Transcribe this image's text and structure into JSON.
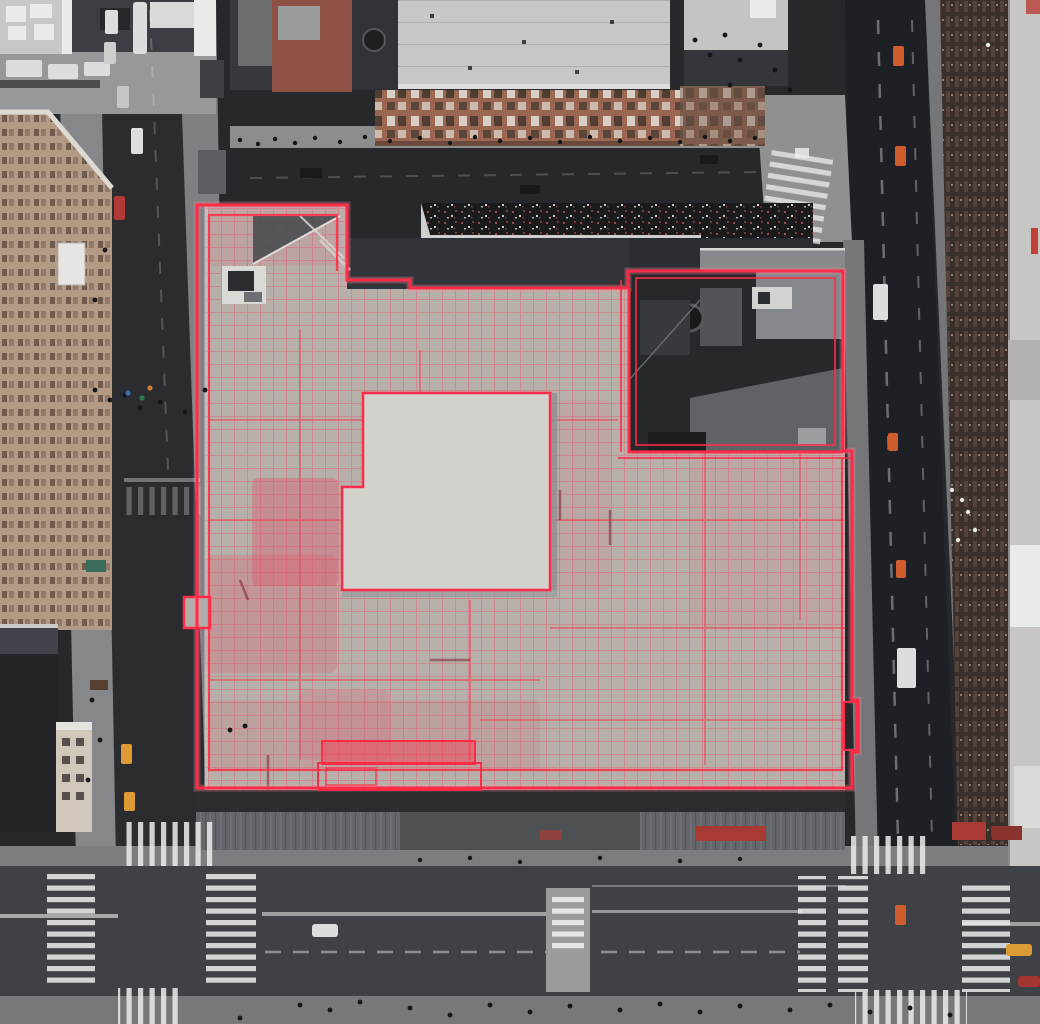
{
  "scene": {
    "type": "aerial-satellite-photograph",
    "subject": "downtown city block viewed from directly overhead",
    "annotation": "red building-footprint outline overlay with CAD-style grid markings on the central rooftop",
    "visible_text": "none",
    "features": {
      "central_block": "large light-gray warehouse rooftop outlined in red",
      "inset_building": "dark rooftop parcel in the north-east corner of the block, separately outlined",
      "raised_roof": "white raised L-shaped roof section at center",
      "green_roof_strip": "dark planted roof strip along the north edge",
      "streets": [
        "left vertical street",
        "top cross street",
        "right avenue",
        "bottom boulevard with median"
      ],
      "crosswalks": "white ladder crosswalks at both intersections",
      "vehicles": [
        "yellow taxis",
        "orange taxis",
        "white box trucks",
        "white cars",
        "red car"
      ],
      "surrounding_buildings": [
        "tan brick mid-rise (west)",
        "red-brick facade block (north)",
        "dark brown high-rise (east)"
      ]
    }
  },
  "colors": {
    "bg_street": "#26282c",
    "avenue": "#1d2024",
    "street_left": "#2a2c30",
    "street_bottom": "#3e4145",
    "sidewalk": "#85878a",
    "sidewalk_dark": "#7e8083",
    "sidewalk_east": "#74767a",
    "sidewalk_bottom": "#76787b",
    "sidewalk_north": "#7b7d80",
    "plaza": "#96989a",
    "plaza_right": "#8e9092",
    "sidewalk_top": "#8b8d90",
    "roof_main": "#b6b4ae",
    "roof_raised": "#d2d1cb",
    "roof_big": "#c5c8c6",
    "roof_light": "#c3c5c3",
    "roof_far_right": "#c8c6c2",
    "strip_green_roof": "#191b1c",
    "shadow_roof": "#303338",
    "shadow_roof2": "#2a2d31",
    "sliver_gray": "#87898c",
    "inset_base": "#26282b",
    "inset_light": "#84878b",
    "inset_mid": "#5f6266",
    "inset_panel": "#515458",
    "dark_roof": "#35383c",
    "dark_roof_light": "#6b6e71",
    "dark_bldg": "#232528",
    "alley": "#27292d",
    "brick_facade": "#9b6753",
    "brick_dark": "#7c5a4c",
    "brick_tower": "#8d5243",
    "tan_building": "#b29a84",
    "tan_small": "#cfc8bb",
    "brown_building": "#3a2f2a",
    "white_struct": "#e9ebe9",
    "white_soft": "#d8dad8",
    "crosswalk_white": "#eceded",
    "median": "#9a9c99",
    "south_face": "#63666a",
    "south_dark": "#2b2d31",
    "banner_red": "#a93a33",
    "annotation": "#ff2b47",
    "annotation_glow": "#ff8a97",
    "annotation_soft": "#ef4358",
    "patch_red": "#e05568",
    "maroon": "#7e2430",
    "taxi_yellow": "#dd9b35",
    "taxi_orange": "#cf5c2d",
    "vehicle_white": "#dcdedd",
    "car_red": "#a33530",
    "pedestrian": "#141619",
    "lane_white": "#ffffff"
  }
}
